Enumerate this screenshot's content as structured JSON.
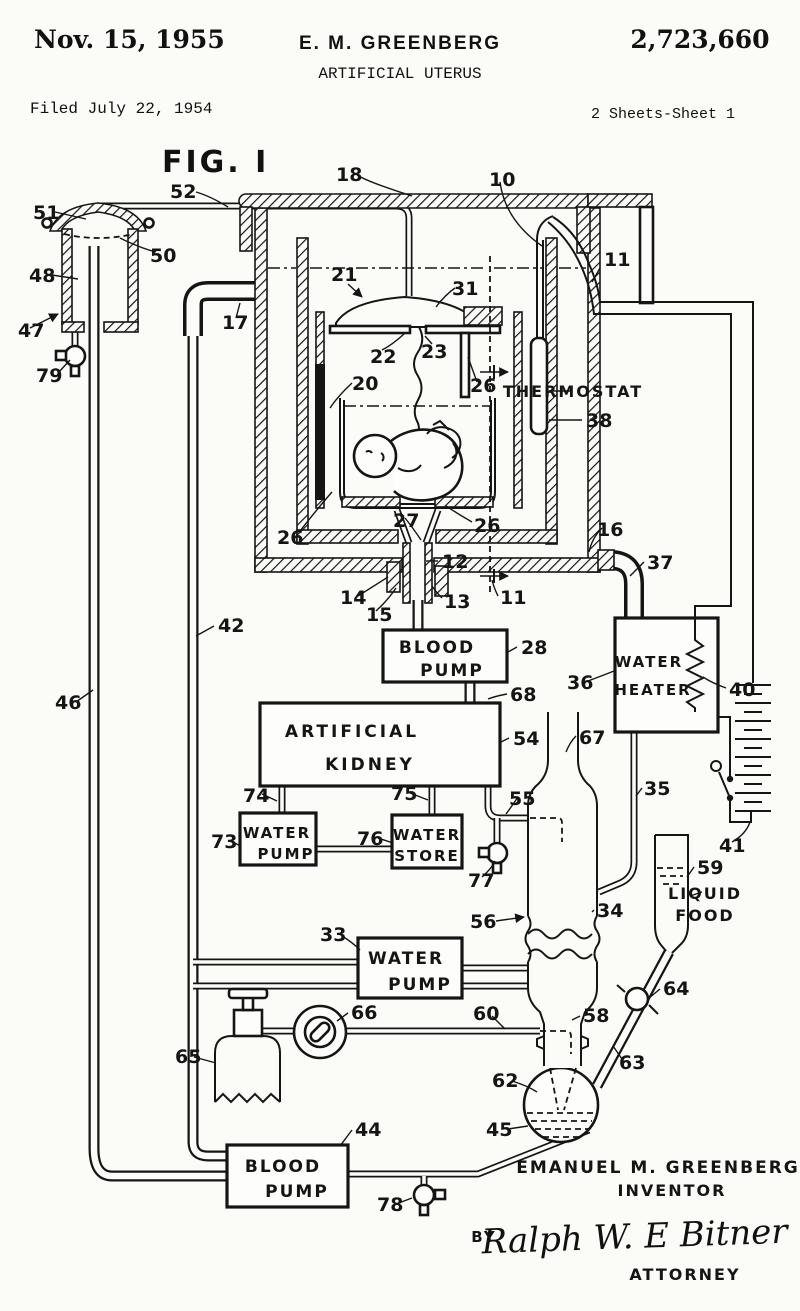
{
  "header": {
    "date": "Nov. 15, 1955",
    "inventor": "E. M. GREENBERG",
    "patent_number": "2,723,660",
    "title": "ARTIFICIAL UTERUS",
    "filed": "Filed July 22, 1954",
    "sheet": "2 Sheets-Sheet 1",
    "figure": "FIG. I"
  },
  "footer": {
    "inventor_name": "EMANUEL M. GREENBERG",
    "inventor_label": "INVENTOR",
    "by": "BY",
    "signature": "Ralph W. E Bitner",
    "attorney": "ATTORNEY"
  },
  "boxes": {
    "blood_pump_top": {
      "line1": "BLOOD",
      "line2": "PUMP"
    },
    "artificial_kidney": {
      "line1": "ARTIFICIAL",
      "line2": "KIDNEY"
    },
    "water_pump_73": {
      "line1": "WATER",
      "line2": "PUMP"
    },
    "water_store": {
      "line1": "WATER",
      "line2": "STORE"
    },
    "water_heater": {
      "line1": "WATER",
      "line2": "HEATER"
    },
    "water_pump_33": {
      "line1": "WATER",
      "line2": "PUMP"
    },
    "blood_pump_44": {
      "line1": "BLOOD",
      "line2": "PUMP"
    }
  },
  "labels": {
    "thermostat": "THERMOSTAT",
    "liquid_food_line1": "LIQUID",
    "liquid_food_line2": "FOOD"
  },
  "colors": {
    "ink": "#151515",
    "paper": "#fbfbf8"
  },
  "ref_labels": [
    {
      "text": "51",
      "x": 33,
      "y": 219
    },
    {
      "text": "48",
      "x": 29,
      "y": 282
    },
    {
      "text": "47",
      "x": 18,
      "y": 337
    },
    {
      "text": "79",
      "x": 36,
      "y": 382
    },
    {
      "text": "50",
      "x": 150,
      "y": 262
    },
    {
      "text": "52",
      "x": 170,
      "y": 198
    },
    {
      "text": "18",
      "x": 336,
      "y": 181
    },
    {
      "text": "10",
      "x": 489,
      "y": 186
    },
    {
      "text": "11",
      "x": 604,
      "y": 266
    },
    {
      "text": "17",
      "x": 222,
      "y": 329
    },
    {
      "text": "21",
      "x": 331,
      "y": 281
    },
    {
      "text": "31",
      "x": 452,
      "y": 295
    },
    {
      "text": "22",
      "x": 370,
      "y": 363
    },
    {
      "text": "23",
      "x": 421,
      "y": 358
    },
    {
      "text": "26",
      "x": 470,
      "y": 392
    },
    {
      "text": "20",
      "x": 352,
      "y": 390
    },
    {
      "text": "38",
      "x": 586,
      "y": 427
    },
    {
      "text": "27",
      "x": 393,
      "y": 527
    },
    {
      "text": "26",
      "x": 277,
      "y": 544
    },
    {
      "text": "26",
      "x": 474,
      "y": 532
    },
    {
      "text": "16",
      "x": 597,
      "y": 536
    },
    {
      "text": "37",
      "x": 647,
      "y": 569
    },
    {
      "text": "12",
      "x": 442,
      "y": 568
    },
    {
      "text": "13",
      "x": 444,
      "y": 608
    },
    {
      "text": "14",
      "x": 340,
      "y": 604
    },
    {
      "text": "15",
      "x": 366,
      "y": 621
    },
    {
      "text": "11",
      "x": 500,
      "y": 604
    },
    {
      "text": "42",
      "x": 218,
      "y": 632
    },
    {
      "text": "46",
      "x": 55,
      "y": 709
    },
    {
      "text": "28",
      "x": 521,
      "y": 654
    },
    {
      "text": "68",
      "x": 510,
      "y": 701
    },
    {
      "text": "54",
      "x": 513,
      "y": 745
    },
    {
      "text": "74",
      "x": 243,
      "y": 802
    },
    {
      "text": "75",
      "x": 391,
      "y": 800
    },
    {
      "text": "73",
      "x": 211,
      "y": 848
    },
    {
      "text": "76",
      "x": 357,
      "y": 845
    },
    {
      "text": "77",
      "x": 468,
      "y": 887
    },
    {
      "text": "55",
      "x": 509,
      "y": 805
    },
    {
      "text": "67",
      "x": 579,
      "y": 744
    },
    {
      "text": "36",
      "x": 567,
      "y": 689
    },
    {
      "text": "40",
      "x": 729,
      "y": 696
    },
    {
      "text": "35",
      "x": 644,
      "y": 795
    },
    {
      "text": "41",
      "x": 719,
      "y": 852
    },
    {
      "text": "59",
      "x": 697,
      "y": 874
    },
    {
      "text": "34",
      "x": 597,
      "y": 917
    },
    {
      "text": "56",
      "x": 470,
      "y": 928
    },
    {
      "text": "33",
      "x": 320,
      "y": 941
    },
    {
      "text": "66",
      "x": 351,
      "y": 1019
    },
    {
      "text": "60",
      "x": 473,
      "y": 1020
    },
    {
      "text": "58",
      "x": 583,
      "y": 1022
    },
    {
      "text": "64",
      "x": 663,
      "y": 995
    },
    {
      "text": "63",
      "x": 619,
      "y": 1069
    },
    {
      "text": "62",
      "x": 492,
      "y": 1087
    },
    {
      "text": "45",
      "x": 486,
      "y": 1136
    },
    {
      "text": "65",
      "x": 175,
      "y": 1063
    },
    {
      "text": "44",
      "x": 355,
      "y": 1136
    },
    {
      "text": "78",
      "x": 377,
      "y": 1211
    }
  ]
}
